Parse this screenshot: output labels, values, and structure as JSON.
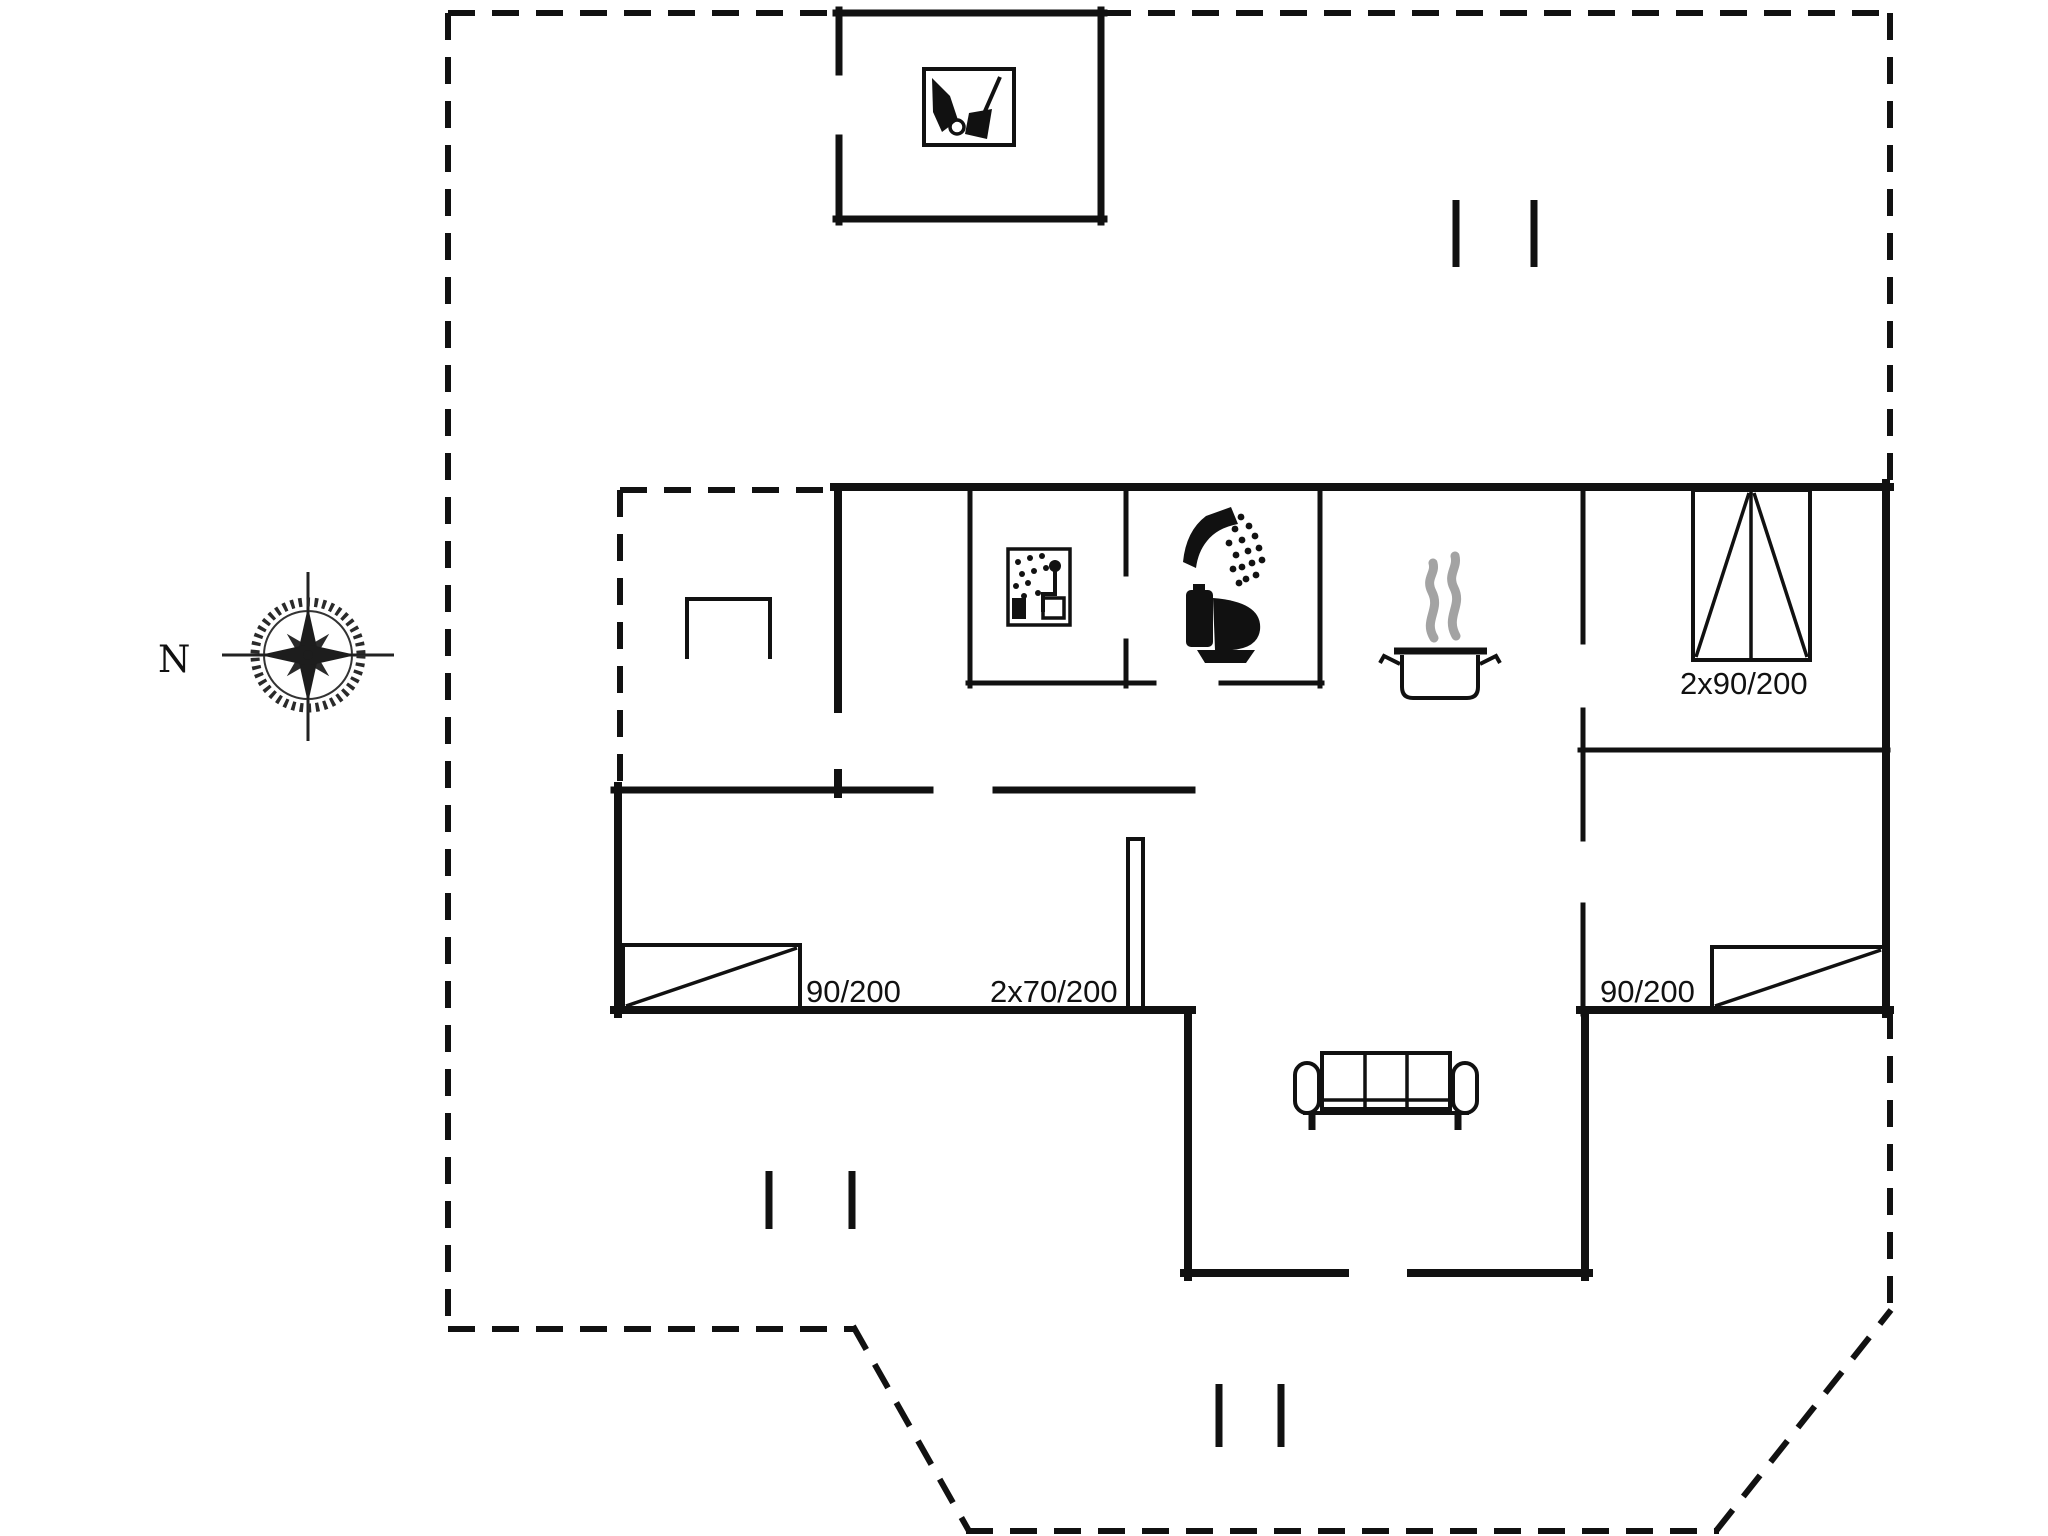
{
  "diagram_type": "floor-plan",
  "colors": {
    "background": "#ffffff",
    "ink": "#111111",
    "steam": "#a3a3a3"
  },
  "compass": {
    "north_label": "N"
  },
  "dimension_labels": {
    "left_bed": "90/200",
    "bunk_bed": "2x70/200",
    "right_bed": "90/200",
    "double_bed": "2x90/200"
  },
  "icons": [
    {
      "name": "compass-rose-icon",
      "meaning": "north orientation"
    },
    {
      "name": "garden-tools-icon",
      "meaning": "tool shed"
    },
    {
      "name": "sauna-icon",
      "meaning": "sauna"
    },
    {
      "name": "shower-icon",
      "meaning": "shower"
    },
    {
      "name": "toilet-icon",
      "meaning": "toilet"
    },
    {
      "name": "cooking-pot-icon",
      "meaning": "kitchen"
    },
    {
      "name": "sofa-icon",
      "meaning": "living room"
    }
  ]
}
